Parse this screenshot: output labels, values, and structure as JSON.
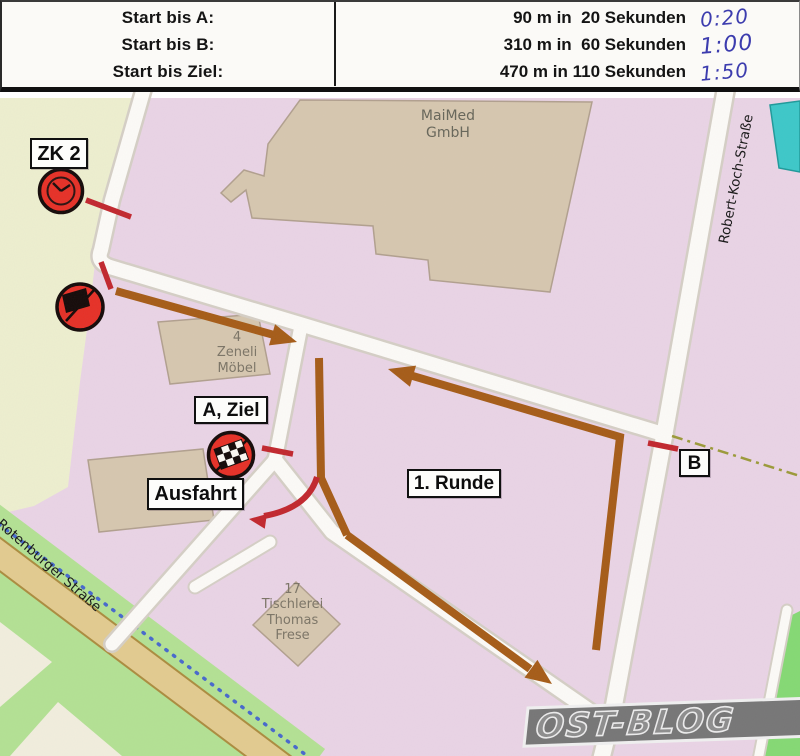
{
  "header": {
    "rows": [
      {
        "label": "Start bis A:",
        "value": "90 m in  20 Sekunden",
        "handwritten": "0:20"
      },
      {
        "label": "Start bis B:",
        "value": "310 m in  60 Sekunden",
        "handwritten": "1:00"
      },
      {
        "label": "Start bis Ziel:",
        "value": "470 m in 110 Sekunden",
        "handwritten": "1:50"
      }
    ]
  },
  "map": {
    "boxes": {
      "zk2": "ZK 2",
      "a_ziel": "A, Ziel",
      "ausfahrt": "Ausfahrt",
      "runde": "1. Runde",
      "b": "B"
    },
    "streets": {
      "robert_koch": "Robert-Koch-Straße",
      "rotenburger": "Rotenburger Straße"
    },
    "places": {
      "maimed": [
        "MaiMed",
        "GmbH"
      ],
      "zeneli": [
        "4",
        "Zeneli",
        "Möbel"
      ],
      "tischlerei": [
        "17",
        "Tischlerei",
        "Thomas",
        "Frese"
      ]
    },
    "watermark": "OST-BLOG"
  },
  "colors": {
    "route_brown": "#a55c17",
    "marker_red": "#c1272d",
    "circle_red": "#e63026",
    "map_pink": "#e9d4e5",
    "field_yellow": "#edefcf",
    "building_tan": "#d6c7af",
    "road_white": "#fcfbf7",
    "street_tan": "#e2cb8f",
    "green": "#b3e193",
    "teal": "#3cc8c8",
    "ink_blue": "#3c3cae"
  }
}
